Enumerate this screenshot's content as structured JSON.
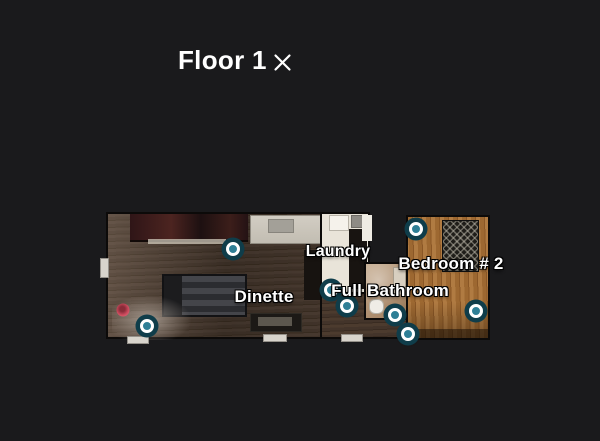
{
  "header": {
    "title": "Floor 1",
    "icons": {
      "close": "x-cross-icon"
    }
  },
  "floorplan": {
    "room_labels": [
      {
        "name": "Laundry",
        "x": 338,
        "y": 252,
        "size": 16
      },
      {
        "name": "Bedroom # 2",
        "x": 451,
        "y": 264,
        "size": 17
      },
      {
        "name": "Dinette",
        "x": 264,
        "y": 297,
        "size": 17
      },
      {
        "name": "Full Bathroom",
        "x": 390,
        "y": 291,
        "size": 17
      }
    ],
    "waypoints": [
      {
        "x": 233,
        "y": 249
      },
      {
        "x": 416,
        "y": 229
      },
      {
        "x": 331,
        "y": 290
      },
      {
        "x": 347,
        "y": 306
      },
      {
        "x": 395,
        "y": 315
      },
      {
        "x": 408,
        "y": 334
      },
      {
        "x": 476,
        "y": 311
      },
      {
        "x": 147,
        "y": 326
      }
    ],
    "camera_position": {
      "x": 123,
      "y": 310
    },
    "colors": {
      "background": "#1a1a1c",
      "waypoint_outer_ring": "#0f3d4a",
      "waypoint_inner_ring": "#ffffff",
      "waypoint_center": "#2e7f96",
      "camera_dot": "#d84a60",
      "label_text": "#ffffff"
    }
  }
}
